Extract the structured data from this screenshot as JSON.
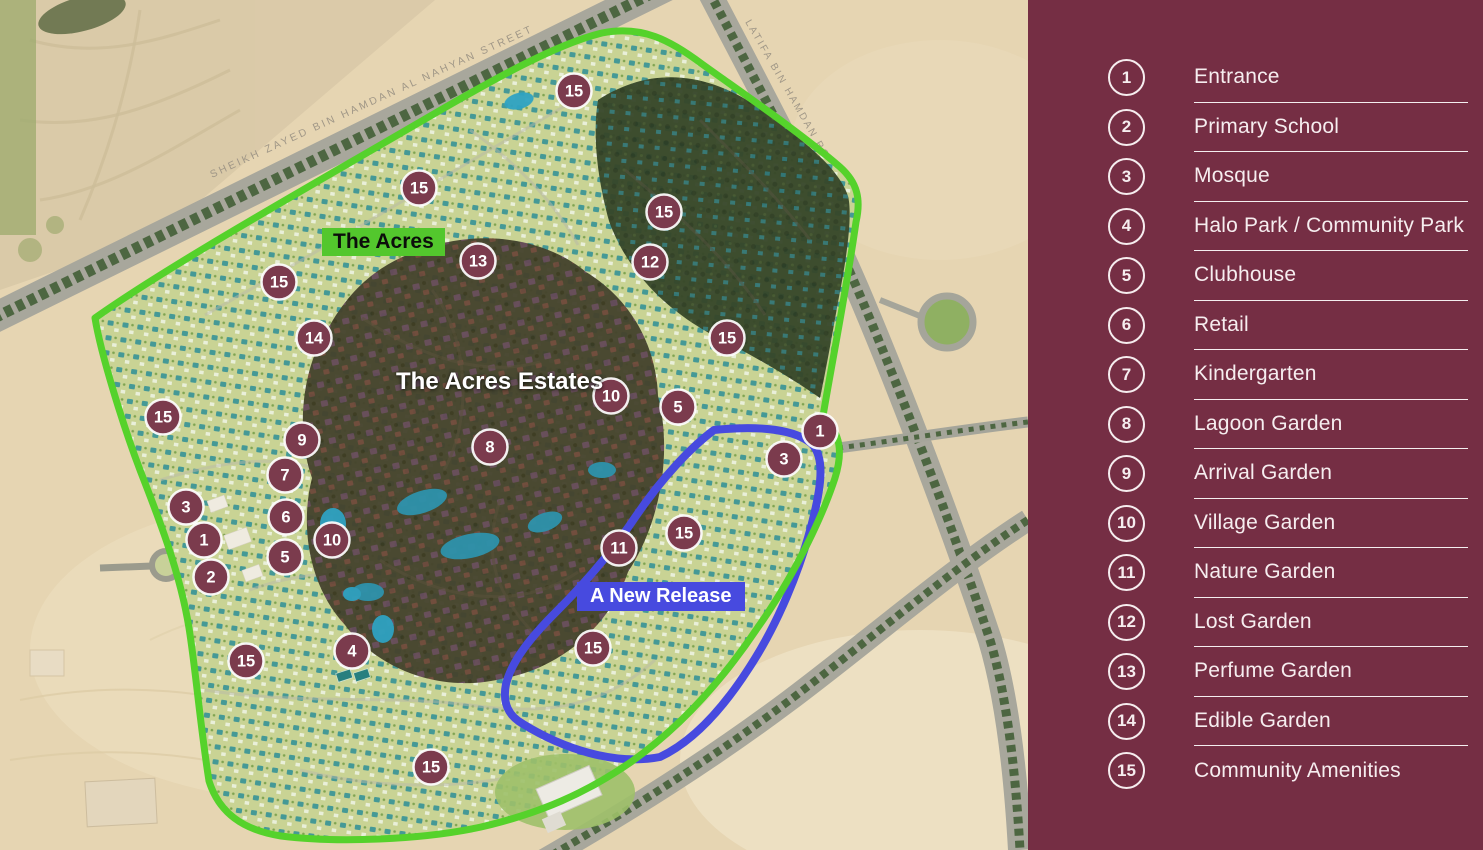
{
  "legend": {
    "panel_color": "#752E44",
    "items": [
      {
        "num": "1",
        "label": "Entrance"
      },
      {
        "num": "2",
        "label": "Primary School"
      },
      {
        "num": "3",
        "label": "Mosque"
      },
      {
        "num": "4",
        "label": "Halo Park / Community Park"
      },
      {
        "num": "5",
        "label": "Clubhouse"
      },
      {
        "num": "6",
        "label": "Retail"
      },
      {
        "num": "7",
        "label": "Kindergarten"
      },
      {
        "num": "8",
        "label": "Lagoon Garden"
      },
      {
        "num": "9",
        "label": "Arrival Garden"
      },
      {
        "num": "10",
        "label": "Village Garden"
      },
      {
        "num": "11",
        "label": "Nature Garden"
      },
      {
        "num": "12",
        "label": "Lost Garden"
      },
      {
        "num": "13",
        "label": "Perfume Garden"
      },
      {
        "num": "14",
        "label": "Edible Garden"
      },
      {
        "num": "15",
        "label": "Community Amenities"
      }
    ]
  },
  "map": {
    "labels": {
      "community": "The Acres",
      "estates": "The Acres Estates",
      "new_release": "A New Release"
    },
    "roads": {
      "sheikh_zayed": "SHEIKH ZAYED BIN HAMDAN AL NAHYAN STREET",
      "latifa": "LATIFA BIN HAMDAN ROAD"
    },
    "colors": {
      "boundary_green": "#55D22B",
      "new_release_blue": "#474ADF",
      "marker_fill": "#7B3B4D",
      "label_green_bg": "#53C72D"
    },
    "markers": [
      {
        "num": "15",
        "x": 574,
        "y": 91
      },
      {
        "num": "15",
        "x": 419,
        "y": 188
      },
      {
        "num": "15",
        "x": 664,
        "y": 212
      },
      {
        "num": "13",
        "x": 478,
        "y": 261
      },
      {
        "num": "12",
        "x": 650,
        "y": 262
      },
      {
        "num": "15",
        "x": 279,
        "y": 282
      },
      {
        "num": "14",
        "x": 314,
        "y": 338
      },
      {
        "num": "15",
        "x": 727,
        "y": 338
      },
      {
        "num": "15",
        "x": 163,
        "y": 417
      },
      {
        "num": "10",
        "x": 611,
        "y": 396
      },
      {
        "num": "5",
        "x": 678,
        "y": 407
      },
      {
        "num": "8",
        "x": 490,
        "y": 447
      },
      {
        "num": "9",
        "x": 302,
        "y": 440
      },
      {
        "num": "7",
        "x": 285,
        "y": 475
      },
      {
        "num": "3",
        "x": 186,
        "y": 507
      },
      {
        "num": "6",
        "x": 286,
        "y": 517
      },
      {
        "num": "1",
        "x": 204,
        "y": 540
      },
      {
        "num": "10",
        "x": 332,
        "y": 540
      },
      {
        "num": "5",
        "x": 285,
        "y": 557
      },
      {
        "num": "2",
        "x": 211,
        "y": 577
      },
      {
        "num": "1",
        "x": 820,
        "y": 431
      },
      {
        "num": "3",
        "x": 784,
        "y": 459
      },
      {
        "num": "15",
        "x": 684,
        "y": 533
      },
      {
        "num": "11",
        "x": 619,
        "y": 548
      },
      {
        "num": "4",
        "x": 352,
        "y": 651
      },
      {
        "num": "15",
        "x": 246,
        "y": 661
      },
      {
        "num": "15",
        "x": 593,
        "y": 648
      },
      {
        "num": "15",
        "x": 431,
        "y": 767
      }
    ]
  }
}
